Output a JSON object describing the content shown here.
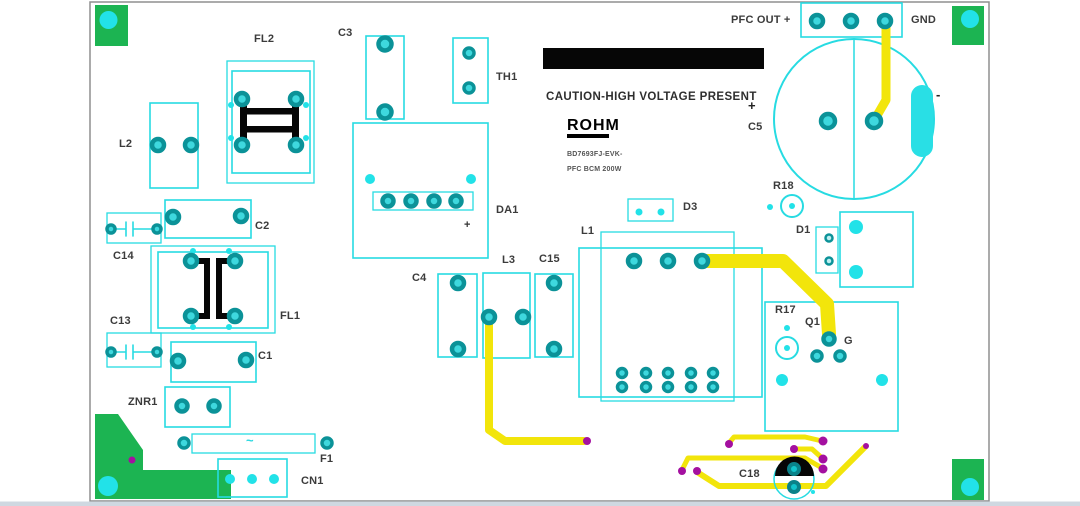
{
  "board": {
    "type": "PCB layout top view",
    "silkscreen": {
      "caution": "CAUTION-HIGH VOLTAGE PRESENT",
      "logo": "ROHM",
      "model": "BD7693FJ-EVK-",
      "power_rating": "PFC BCM 200W",
      "pfc_out_label": "PFC OUT +",
      "gnd_label": "GND",
      "c5_plus": "+",
      "c5_minus": "-",
      "da1_plus": "+",
      "fuse_symbol": "~"
    },
    "components": {
      "l2": "L2",
      "fl2": "FL2",
      "c3": "C3",
      "th1": "TH1",
      "c2": "C2",
      "c14": "C14",
      "fl1": "FL1",
      "c13": "C13",
      "c1": "C1",
      "znr1": "ZNR1",
      "f1": "F1",
      "cn1": "CN1",
      "da1": "DA1",
      "c4": "C4",
      "l3": "L3",
      "c15": "C15",
      "l1": "L1",
      "d3": "D3",
      "c5": "C5",
      "r18": "R18",
      "d1": "D1",
      "r17": "R17",
      "q1": "Q1",
      "g": "G",
      "c18": "C18"
    },
    "colors": {
      "copper_outline_cyan": "#27dbe2",
      "pad_ring_teal": "#0b9298",
      "pad_core_teal": "#3ed8de",
      "trace_yellow": "#f2e50b",
      "via_magenta": "#a410a0",
      "mounting_green": "#1cb452",
      "silk_black": "#060606",
      "label_gray": "#3b3b3b",
      "board_border_gray": "#8f8f8f"
    }
  }
}
